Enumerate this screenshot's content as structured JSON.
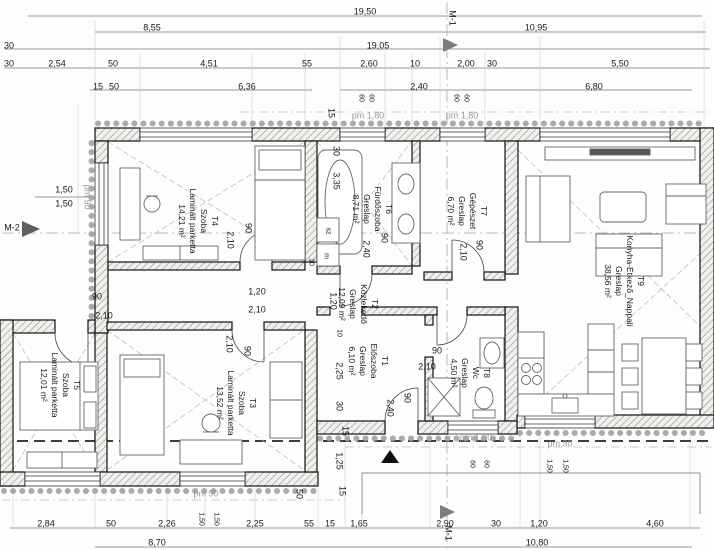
{
  "drawing_type": "floor-plan",
  "rooms": [
    {
      "tag": "T1",
      "name": "Előszoba",
      "flooring": "Greslap",
      "area": "6,10 m²"
    },
    {
      "tag": "T2",
      "name": "Közlekedő",
      "flooring": "Greslap",
      "area": "12,09 m²"
    },
    {
      "tag": "T3",
      "name": "Szoba",
      "flooring": "Laminált parketta",
      "area": "13,52 m²"
    },
    {
      "tag": "T4",
      "name": "Szoba",
      "flooring": "Laminált parketta",
      "area": "14,21 m²"
    },
    {
      "tag": "T5",
      "name": "Szoba",
      "flooring": "Laminált parketta",
      "area": "12,01 m²"
    },
    {
      "tag": "T6",
      "name": "Fürdőszoba",
      "flooring": "Greslap",
      "area": "8,71 m²"
    },
    {
      "tag": "T7",
      "name": "Gépészet",
      "flooring": "Greslap",
      "area": "6,70 m²"
    },
    {
      "tag": "T8",
      "name": "Wc",
      "flooring": "Greslap",
      "area": "4,50 m²"
    },
    {
      "tag": "T9",
      "name": "Konyha-Étkező_Nappali",
      "flooring": "Greslap",
      "area": "38,56 m²"
    }
  ],
  "dim_labels": [
    {
      "t": "19,50",
      "x": 365,
      "y": 12
    },
    {
      "t": "8,55",
      "x": 152,
      "y": 28
    },
    {
      "t": "10,95",
      "x": 536,
      "y": 28
    },
    {
      "t": "30",
      "x": 9,
      "y": 46
    },
    {
      "t": "19,05",
      "x": 378,
      "y": 46
    },
    {
      "t": "30",
      "x": 9,
      "y": 64
    },
    {
      "t": "2,54",
      "x": 57,
      "y": 64
    },
    {
      "t": "50",
      "x": 113,
      "y": 64
    },
    {
      "t": "4,51",
      "x": 209,
      "y": 64
    },
    {
      "t": "55",
      "x": 307,
      "y": 64
    },
    {
      "t": "2,60",
      "x": 369,
      "y": 64
    },
    {
      "t": "10",
      "x": 415,
      "y": 64
    },
    {
      "t": "2,00",
      "x": 466,
      "y": 64
    },
    {
      "t": "30",
      "x": 492,
      "y": 64
    },
    {
      "t": "5,50",
      "x": 620,
      "y": 64
    },
    {
      "t": "15",
      "x": 98,
      "y": 87
    },
    {
      "t": "50",
      "x": 114,
      "y": 87
    },
    {
      "t": "6,36",
      "x": 247,
      "y": 87
    },
    {
      "t": "2,40",
      "x": 419,
      "y": 87
    },
    {
      "t": "6,80",
      "x": 594,
      "y": 87
    },
    {
      "t": "60",
      "x": 361,
      "y": 98,
      "r": 1,
      "s": 1
    },
    {
      "t": "60",
      "x": 371,
      "y": 98,
      "r": 1,
      "s": 1
    },
    {
      "t": "60",
      "x": 456,
      "y": 98,
      "r": 1,
      "s": 1
    },
    {
      "t": "60",
      "x": 466,
      "y": 98,
      "r": 1,
      "s": 1
    },
    {
      "t": "pm 1,80",
      "x": 368,
      "y": 116,
      "g": 1,
      "n": "parapet-label"
    },
    {
      "t": "pm 1,80",
      "x": 462,
      "y": 116,
      "g": 1,
      "n": "parapet-label"
    },
    {
      "t": "15",
      "x": 331,
      "y": 113,
      "r": 1
    },
    {
      "t": "1,50",
      "x": 64,
      "y": 190
    },
    {
      "t": "1,50",
      "x": 64,
      "y": 204
    },
    {
      "t": "pm 90",
      "x": 87,
      "y": 197,
      "r": 1,
      "g": 1,
      "n": "parapet-label"
    },
    {
      "t": "30",
      "x": 336,
      "y": 151,
      "r": 1
    },
    {
      "t": "3,35",
      "x": 336,
      "y": 181,
      "r": 1
    },
    {
      "t": "90",
      "x": 248,
      "y": 228,
      "r": 1
    },
    {
      "t": "2,10",
      "x": 230,
      "y": 240,
      "r": 1
    },
    {
      "t": "90",
      "x": 384,
      "y": 238,
      "r": 1
    },
    {
      "t": "2,40",
      "x": 366,
      "y": 249,
      "r": 1
    },
    {
      "t": "90",
      "x": 479,
      "y": 245,
      "r": 1
    },
    {
      "t": "2,10",
      "x": 463,
      "y": 252,
      "r": 1
    },
    {
      "t": "1,20",
      "x": 257,
      "y": 292
    },
    {
      "t": "2,10",
      "x": 257,
      "y": 310
    },
    {
      "t": "90",
      "x": 97,
      "y": 297
    },
    {
      "t": "2,10",
      "x": 104,
      "y": 316
    },
    {
      "t": "sz",
      "x": 328,
      "y": 231,
      "r": 1,
      "s": 1
    },
    {
      "t": "m",
      "x": 326,
      "y": 256,
      "r": 1,
      "s": 1
    },
    {
      "t": "10",
      "x": 311,
      "y": 262,
      "r": 1,
      "s": 1
    },
    {
      "t": "10",
      "x": 339,
      "y": 333,
      "r": 1,
      "s": 1
    },
    {
      "t": "1,20",
      "x": 333,
      "y": 301,
      "r": 1
    },
    {
      "t": "2,10",
      "x": 229,
      "y": 344,
      "r": 1
    },
    {
      "t": "90",
      "x": 247,
      "y": 351,
      "r": 1
    },
    {
      "t": "2,25",
      "x": 339,
      "y": 371,
      "r": 1
    },
    {
      "t": "30",
      "x": 339,
      "y": 406,
      "r": 1
    },
    {
      "t": "15",
      "x": 345,
      "y": 431,
      "r": 1
    },
    {
      "t": "1,25",
      "x": 339,
      "y": 461,
      "r": 1
    },
    {
      "t": "15",
      "x": 342,
      "y": 491,
      "r": 1
    },
    {
      "t": "50",
      "x": 299,
      "y": 494,
      "r": 1
    },
    {
      "t": "90",
      "x": 407,
      "y": 398,
      "r": 1
    },
    {
      "t": "2,40",
      "x": 390,
      "y": 408,
      "r": 1
    },
    {
      "t": "90",
      "x": 437,
      "y": 351
    },
    {
      "t": "2,10",
      "x": 427,
      "y": 367
    },
    {
      "t": "pm 1,80",
      "x": 476,
      "y": 438,
      "g": 1,
      "n": "parapet-label"
    },
    {
      "t": "pm 90",
      "x": 560,
      "y": 444,
      "g": 1,
      "n": "parapet-label"
    },
    {
      "t": "pm 90",
      "x": 206,
      "y": 494,
      "g": 1,
      "n": "parapet-label"
    },
    {
      "t": "60",
      "x": 472,
      "y": 464,
      "r": 1,
      "s": 1
    },
    {
      "t": "60",
      "x": 486,
      "y": 464,
      "r": 1,
      "s": 1
    },
    {
      "t": "1,50",
      "x": 549,
      "y": 466,
      "r": 1,
      "s": 1
    },
    {
      "t": "1,50",
      "x": 565,
      "y": 466,
      "r": 1,
      "s": 1
    },
    {
      "t": "1,50",
      "x": 201,
      "y": 519,
      "r": 1,
      "s": 1
    },
    {
      "t": "1,50",
      "x": 216,
      "y": 519,
      "r": 1,
      "s": 1
    },
    {
      "t": "2,84",
      "x": 46,
      "y": 524
    },
    {
      "t": "50",
      "x": 111,
      "y": 524
    },
    {
      "t": "2,26",
      "x": 167,
      "y": 524
    },
    {
      "t": "2,25",
      "x": 255,
      "y": 524
    },
    {
      "t": "55",
      "x": 309,
      "y": 524
    },
    {
      "t": "15",
      "x": 330,
      "y": 524
    },
    {
      "t": "1,65",
      "x": 359,
      "y": 524
    },
    {
      "t": "2,90",
      "x": 445,
      "y": 524
    },
    {
      "t": "30",
      "x": 496,
      "y": 524
    },
    {
      "t": "1,20",
      "x": 539,
      "y": 524
    },
    {
      "t": "4,60",
      "x": 655,
      "y": 524
    },
    {
      "t": "8,70",
      "x": 157,
      "y": 543
    },
    {
      "t": "10,80",
      "x": 537,
      "y": 543
    },
    {
      "t": "M-1",
      "x": 452,
      "y": 18,
      "r": 1,
      "n": "section-marker-m1"
    },
    {
      "t": "M-1",
      "x": 448,
      "y": 533,
      "r": 1,
      "n": "section-marker-m1"
    },
    {
      "t": "M-2",
      "x": 12,
      "y": 228,
      "n": "section-marker-m2"
    }
  ]
}
